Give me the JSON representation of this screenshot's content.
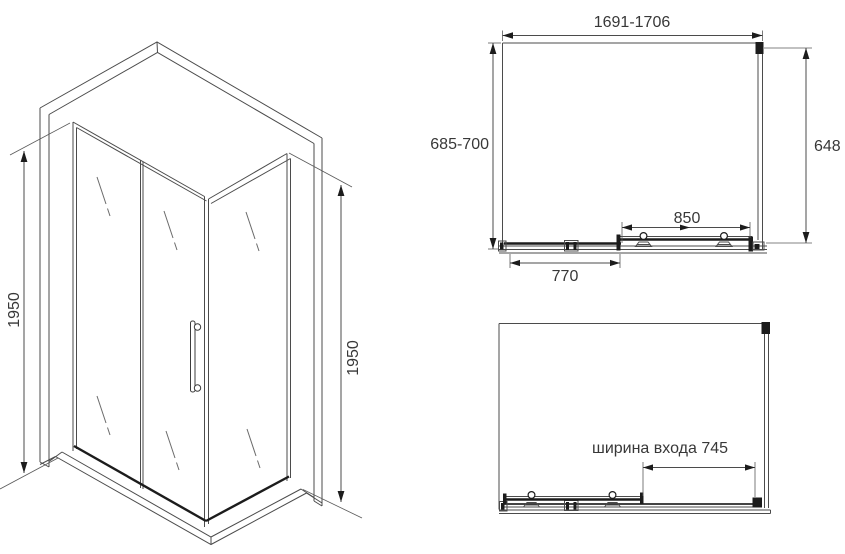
{
  "drawing_title": "shower-enclosure-dimension-drawing",
  "colors": {
    "background": "#ffffff",
    "line": "#4b4b4b",
    "profile_dark": "#1c1c1c",
    "text": "#383838"
  },
  "isometric_view": {
    "height_left": "1950",
    "height_right": "1950"
  },
  "plan_view": {
    "overall_width": "1691-1706",
    "overall_depth": "685-700",
    "side_panel_width": "648",
    "door_width": "850",
    "fixed_panel_width": "770"
  },
  "open_view": {
    "entry_width": "ширина входа 745"
  }
}
